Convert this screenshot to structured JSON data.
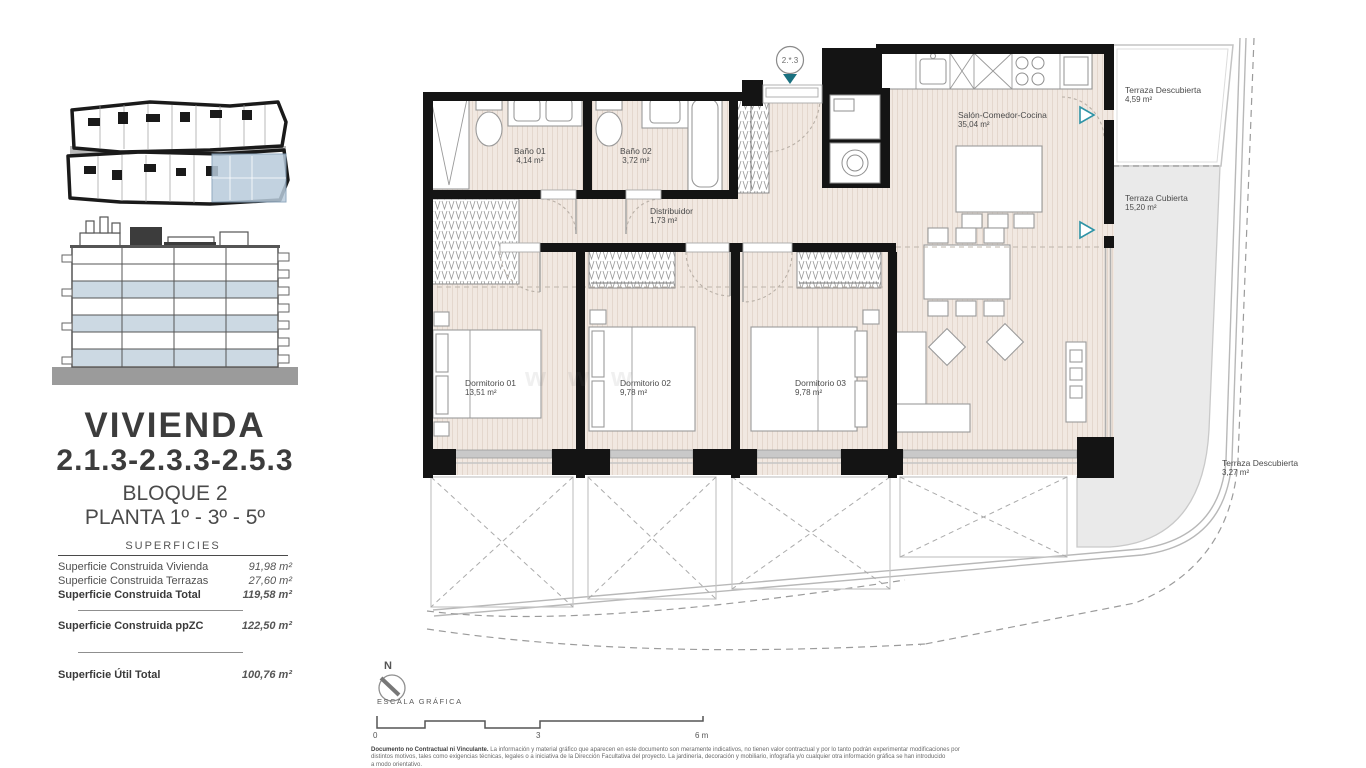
{
  "sidebar": {
    "title": "VIVIENDA",
    "units": "2.1.3-2.3.3-2.5.3",
    "block": "BLOQUE 2",
    "floor": "PLANTA 1º - 3º - 5º",
    "surfaces_title": "SUPERFICIES",
    "rows": [
      {
        "label": "Superficie Construida Vivienda",
        "value": "91,98 m²"
      },
      {
        "label": "Superficie Construida Terrazas",
        "value": "27,60 m²"
      },
      {
        "label": "Superficie Construida Total",
        "value": "119,58 m²"
      },
      {
        "label": "Superficie Construida ppZC",
        "value": "122,50 m²"
      },
      {
        "label": "Superficie Útil Total",
        "value": "100,76 m²"
      }
    ]
  },
  "plan": {
    "unit_marker": "2.*.3",
    "watermark": "www",
    "rooms": [
      {
        "name": "Baño 01",
        "area": "4,14 m²"
      },
      {
        "name": "Baño 02",
        "area": "3,72 m²"
      },
      {
        "name": "Distribuidor",
        "area": "1,73 m²"
      },
      {
        "name": "Salón-Comedor-Cocina",
        "area": "35,04 m²"
      },
      {
        "name": "Dormitorio 01",
        "area": "13,51 m²"
      },
      {
        "name": "Dormitorio 02",
        "area": "9,78 m²"
      },
      {
        "name": "Dormitorio 03",
        "area": "9,78 m²"
      },
      {
        "name": "Terraza Descubierta",
        "area": "4,59 m²"
      },
      {
        "name": "Terraza Cubierta",
        "area": "15,20 m²"
      },
      {
        "name": "Terraza Descubierta",
        "area": "3,27 m²"
      }
    ]
  },
  "footer": {
    "north": "N",
    "scale_title": "ESCALA GRÁFICA",
    "scale_ticks": [
      "0",
      "3",
      "6 m"
    ],
    "disclaimer_lead": "Documento no Contractual ni Vinculante.",
    "disclaimer_1": " La información y material gráfico que aparecen en este documento son meramente indicativos, no tienen valor contractual y por lo tanto podrán experimentar modificaciones por",
    "disclaimer_2": "distintos motivos, tales como exigencias técnicas, legales o a iniciativa de la Dirección Facultativa del proyecto. La jardinería, decoración y mobiliario, infografía y/o cualquier otra información gráfica se han introducido",
    "disclaimer_3": "a modo orientativo."
  },
  "colors": {
    "wall": "#141414",
    "floor": "#f1e8e1",
    "terrace_gray": "#eaeaea",
    "accent_teal": "#2e93a6",
    "entrance_teal": "#19707f",
    "highlight_blue": "#b8cbdb"
  }
}
